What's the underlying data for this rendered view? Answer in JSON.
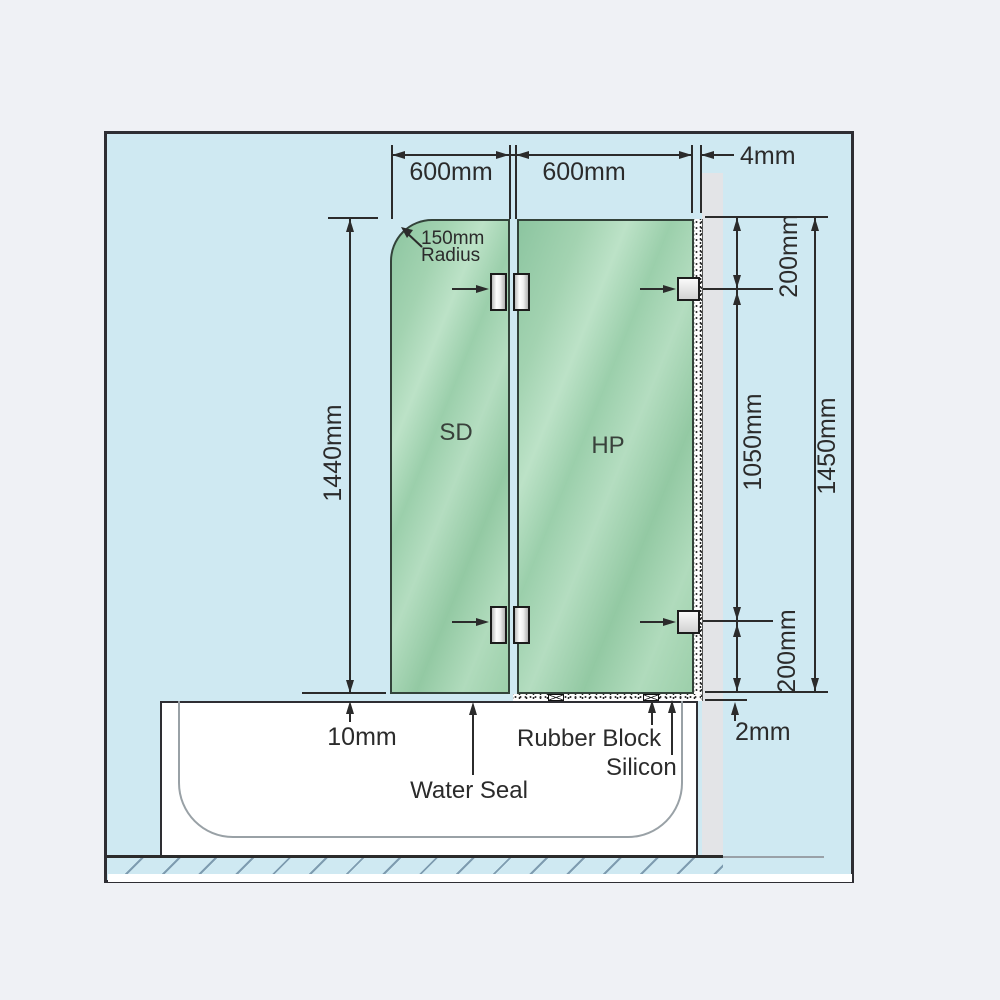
{
  "diagram": {
    "dimensions": {
      "sd_width": "600mm",
      "hp_width": "600mm",
      "wall_gap": "4mm",
      "sd_height": "1440mm",
      "top_bracket_offset": "200mm",
      "bracket_spacing": "1050mm",
      "panel_height": "1450mm",
      "bottom_bracket_offset": "200mm",
      "sd_bottom_gap": "10mm",
      "hp_bottom_gap": "2mm"
    },
    "labels": {
      "radius_line1": "150mm",
      "radius_line2": "Radius",
      "sd": "SD",
      "hp": "HP",
      "water_seal": "Water Seal",
      "rubber_block": "Rubber Block",
      "silicon": "Silicon"
    },
    "colors": {
      "page_background": "#eff1f5",
      "panel_background": "#cfe9f2",
      "glass_green": "#9ccfaa",
      "wall_gray": "#e3e4e7",
      "line": "#2b2b2b"
    }
  }
}
